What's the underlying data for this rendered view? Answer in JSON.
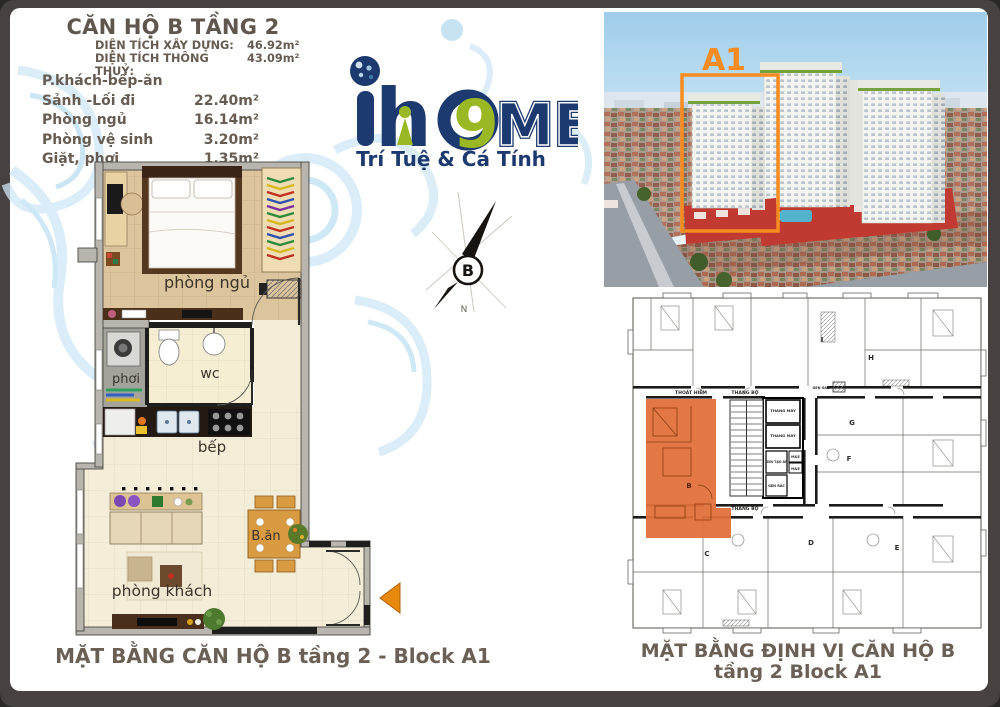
{
  "header": {
    "title": "CĂN HỘ B TẦNG 2",
    "area_lines": [
      {
        "label": "DIỆN TÍCH XÂY DỰNG:",
        "value": "46.92m²"
      },
      {
        "label": "DIỆN TÍCH THÔNG THUỶ:",
        "value": "43.09m²"
      }
    ],
    "rooms": [
      {
        "label": "P.khách-bếp-ăn",
        "value": ""
      },
      {
        "label": "Sảnh -Lối đi",
        "value": "22.40m²"
      },
      {
        "label": "Phòng ngủ",
        "value": "16.14m²"
      },
      {
        "label": "Phòng vệ sinh",
        "value": "3.20m²"
      },
      {
        "label": "Giặt, phơi",
        "value": "1.35m²"
      }
    ]
  },
  "logo": {
    "letter_i": "i",
    "letter_h": "h",
    "digit": "9",
    "letters_me": "ME",
    "tagline": "Trí Tuệ & Cá Tính",
    "navy": "#1d3a70",
    "green": "#9ab824"
  },
  "photo": {
    "block_label": "A1",
    "accent": "#f68b1f"
  },
  "compass": {
    "north_letter": "B",
    "south_letter": "N"
  },
  "apartment_plan": {
    "labels": {
      "bedroom": "phòng ngủ",
      "laundry": "phơi",
      "wc": "wc",
      "kitchen": "bếp",
      "dining": "B.ăn",
      "living": "phòng khách"
    }
  },
  "floor_plate": {
    "units": {
      "b": "B",
      "c": "C",
      "d": "D",
      "e": "E",
      "f": "F",
      "g": "G",
      "h": "H",
      "i": "I"
    },
    "labels": {
      "escape": "THOÁT HIỂM",
      "stair_top": "THANG BỘ",
      "stair_bottom": "THANG BỘ",
      "lift": "THANG MÁY",
      "gen_tao_ap": "GEN TẠO ÁP",
      "me": "M&E",
      "gen_rac": "GEN RÁC",
      "gen_gaz": "GEN GAZ"
    },
    "highlight": "#e2713c"
  },
  "captions": {
    "left": "MẶT BẰNG CĂN HỘ B tầng 2 - Block A1",
    "right_line1": "MẶT BẰNG ĐỊNH VỊ CĂN HỘ B",
    "right_line2": "tầng 2  Block A1"
  }
}
